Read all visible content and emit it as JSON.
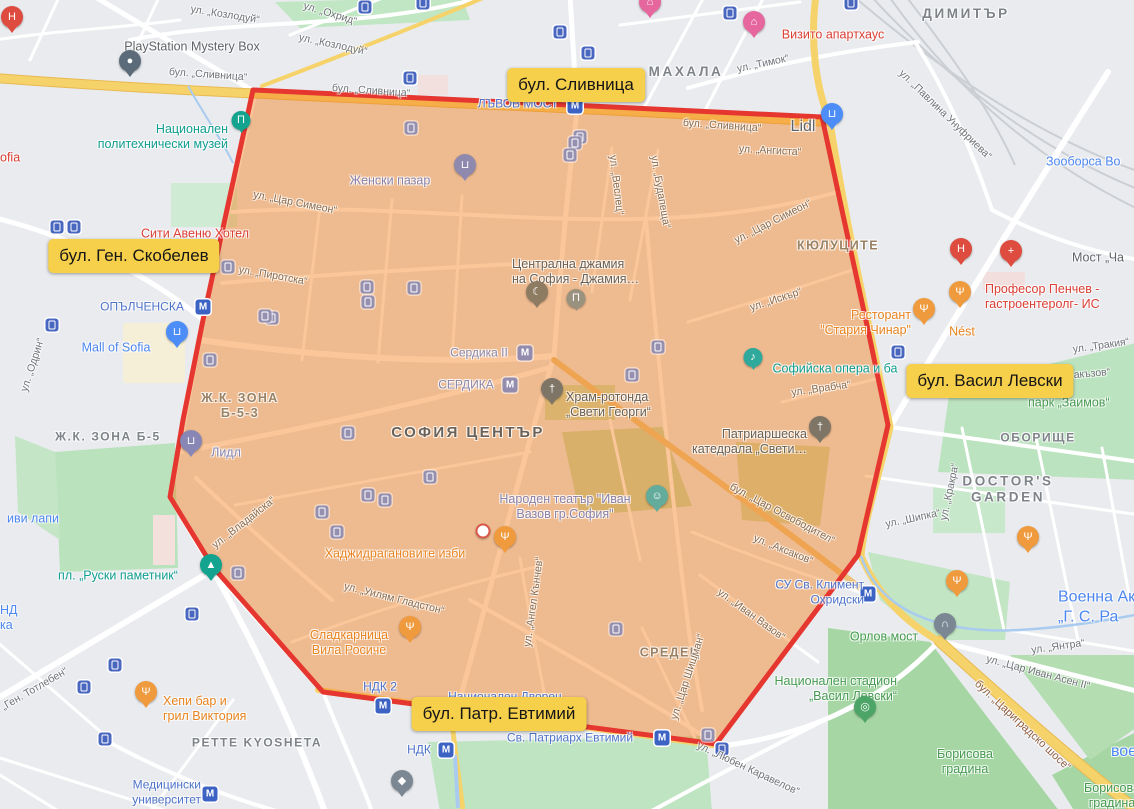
{
  "zone": {
    "points": "253,90 822,117 843,215 868,330 888,425 858,555 716,744 323,692 213,567 170,497 183,420 203,320",
    "fill": "#F5811E",
    "fill_opacity": 0.45,
    "stroke": "#E53730",
    "stroke_width": 5
  },
  "highlight_labels": [
    {
      "t": "бул. Сливница",
      "x": 576,
      "y": 85
    },
    {
      "t": "бул. Ген. Скобелев",
      "x": 134,
      "y": 256
    },
    {
      "t": "бул. Васил Левски",
      "x": 990,
      "y": 381
    },
    {
      "t": "бул. Патр. Евтимий",
      "x": 499,
      "y": 714
    }
  ],
  "map": {
    "districts": [
      {
        "t": "МАХАЛА",
        "x": 686,
        "y": 72,
        "c": "district district-md"
      },
      {
        "t": "ДИМИТЪР",
        "x": 966,
        "y": 14,
        "c": "district district-md"
      },
      {
        "t": "КЮЛУЦИТЕ",
        "x": 838,
        "y": 246,
        "c": "district-in"
      },
      {
        "t": "Ж.К. ЗОНА Б-5",
        "x": 108,
        "y": 437,
        "c": "district"
      },
      {
        "t": "Ж.К. ЗОНА\nБ-5-3",
        "x": 240,
        "y": 406,
        "c": "district-in"
      },
      {
        "t": "СОФИЯ ЦЕНТЪР",
        "x": 468,
        "y": 433,
        "c": "district-lg"
      },
      {
        "t": "СРЕДЕЦ",
        "x": 670,
        "y": 653,
        "c": "district-in"
      },
      {
        "t": "ОБОРИЩЕ",
        "x": 1038,
        "y": 438,
        "c": "district"
      },
      {
        "t": "DOCTOR'S\nGARDEN",
        "x": 1008,
        "y": 490,
        "c": "district district-md"
      },
      {
        "t": "PETTE KYOSHETA",
        "x": 257,
        "y": 743,
        "c": "district"
      }
    ],
    "streets": [
      {
        "t": "ул. „Козлодуй“",
        "x": 225,
        "y": 15,
        "c": "street",
        "r": 9
      },
      {
        "t": "ул. „Козлодуй“",
        "x": 333,
        "y": 45,
        "c": "street",
        "r": 12
      },
      {
        "t": "ул. „Охрид“",
        "x": 330,
        "y": 14,
        "c": "street",
        "r": 17
      },
      {
        "t": "бул. „Сливница“",
        "x": 208,
        "y": 75,
        "c": "street",
        "r": 4
      },
      {
        "t": "бул. „Сливница“",
        "x": 371,
        "y": 91,
        "c": "street",
        "r": 4
      },
      {
        "t": "бул. „Сливница“",
        "x": 722,
        "y": 126,
        "c": "street-in",
        "r": 4
      },
      {
        "t": "ул. „Тимок“",
        "x": 763,
        "y": 64,
        "c": "street",
        "r": -12
      },
      {
        "t": "ул. „Павлина Унуфриева“",
        "x": 945,
        "y": 115,
        "c": "street",
        "r": 44
      },
      {
        "t": "ул. „Ангиста“",
        "x": 770,
        "y": 151,
        "c": "street-in",
        "r": 3
      },
      {
        "t": "ул. „Веслец“",
        "x": 616,
        "y": 185,
        "c": "street-in",
        "r": 83
      },
      {
        "t": "ул. „Будапеща“",
        "x": 660,
        "y": 192,
        "c": "street-in",
        "r": 80
      },
      {
        "t": "ул. „Цар Симеон“",
        "x": 295,
        "y": 203,
        "c": "street-in",
        "r": 11
      },
      {
        "t": "ул. „Цар Симеон“",
        "x": 773,
        "y": 222,
        "c": "street-in",
        "r": -27
      },
      {
        "t": "ул. „Пиротска“",
        "x": 273,
        "y": 276,
        "c": "street-in",
        "r": 10
      },
      {
        "t": "ул. „Искър“",
        "x": 776,
        "y": 300,
        "c": "street-in",
        "r": -18
      },
      {
        "t": "ул. „Тракия“",
        "x": 1101,
        "y": 346,
        "c": "street",
        "r": -8
      },
      {
        "t": "акъзов“",
        "x": 1092,
        "y": 374,
        "c": "street",
        "r": -5
      },
      {
        "t": "ул. „Врабча“",
        "x": 821,
        "y": 389,
        "c": "street-in",
        "r": -8
      },
      {
        "t": "ул. „Одрин“",
        "x": 33,
        "y": 365,
        "c": "street",
        "r": -72
      },
      {
        "t": "ул. „Кракра“",
        "x": 950,
        "y": 492,
        "c": "street",
        "r": -78
      },
      {
        "t": "ул. „Шипка“",
        "x": 913,
        "y": 519,
        "c": "street",
        "r": -12
      },
      {
        "t": "бул. „Цар Освободител“",
        "x": 782,
        "y": 514,
        "c": "street-in",
        "r": 28
      },
      {
        "t": "ул. „Аксаков“",
        "x": 783,
        "y": 550,
        "c": "street-in",
        "r": 22
      },
      {
        "t": "ул. „Владайска“",
        "x": 244,
        "y": 523,
        "c": "street-in",
        "r": -38
      },
      {
        "t": "ул. „Уилям Гладстон“",
        "x": 394,
        "y": 599,
        "c": "street-in",
        "r": 14
      },
      {
        "t": "ул. „Ангел Кънчев“",
        "x": 534,
        "y": 602,
        "c": "street-in",
        "r": -82
      },
      {
        "t": "ул. „Иван Вазов“",
        "x": 751,
        "y": 615,
        "c": "street-in",
        "r": 36
      },
      {
        "t": "ул. „Цар Шишман“",
        "x": 688,
        "y": 677,
        "c": "street-in",
        "r": -72
      },
      {
        "t": "ул. „Любен Каравелов“",
        "x": 748,
        "y": 769,
        "c": "street",
        "r": 25
      },
      {
        "t": "ул. „Янтра“",
        "x": 1058,
        "y": 647,
        "c": "street",
        "r": -8
      },
      {
        "t": "ул. „Цар Иван Асен II“",
        "x": 1038,
        "y": 673,
        "c": "street",
        "r": 15
      },
      {
        "t": "бул. „Цариградско шосе“",
        "x": 1022,
        "y": 726,
        "c": "street-brown",
        "r": 43
      },
      {
        "t": "бул. „Ген. Тотлебен“",
        "x": 25,
        "y": 695,
        "c": "street",
        "r": -30
      }
    ],
    "pois": [
      {
        "t": "PlayStation Mystery Box",
        "x": 192,
        "y": 47,
        "c": "poi-gray poi-lg"
      },
      {
        "t": "Национален\nполитехнически музей",
        "x": 228,
        "y": 137,
        "c": "poi-teal poi-lg",
        "a": "r"
      },
      {
        "t": "Сити Авеню Хотел",
        "x": 195,
        "y": 234,
        "c": "poi-red poi-lg"
      },
      {
        "t": "ofia",
        "x": 0,
        "y": 158,
        "c": "poi-red poi-lg",
        "a": "l"
      },
      {
        "t": "Визито апартхаус",
        "x": 833,
        "y": 35,
        "c": "poi-red poi-lg"
      },
      {
        "t": "Зооборса Во",
        "x": 1046,
        "y": 162,
        "c": "poi-blue poi-lg",
        "a": "l"
      },
      {
        "t": "Мост „Ча",
        "x": 1072,
        "y": 258,
        "c": "poi-gray poi-lg",
        "a": "l"
      },
      {
        "t": "Професор Пенчев -\nгастроентеролг- ИС",
        "x": 985,
        "y": 297,
        "c": "poi-red poi-lg",
        "a": "l"
      },
      {
        "t": "Ресторант\n\"Стария Чинар\"",
        "x": 911,
        "y": 323,
        "c": "poi-orange poi-lg",
        "a": "r"
      },
      {
        "t": "Nést",
        "x": 962,
        "y": 332,
        "c": "poi-orange poi-lg"
      },
      {
        "t": "Софийска опера и ба",
        "x": 835,
        "y": 369,
        "c": "poi-teal poi-lg under"
      },
      {
        "t": "парк „Заимов“",
        "x": 1028,
        "y": 403,
        "c": "poi-green poi-lg",
        "a": "l"
      },
      {
        "t": "Lidl",
        "x": 803,
        "y": 127,
        "c": "poi-gray"
      },
      {
        "t": "Женски пазар",
        "x": 390,
        "y": 181,
        "c": "poi-purple poi-lg"
      },
      {
        "t": "Централна джамия\nна София - Джамия…",
        "x": 512,
        "y": 272,
        "c": "poi-dark poi-lg",
        "a": "l"
      },
      {
        "t": "Храм-ротонда\n„Свети Георги“",
        "x": 566,
        "y": 405,
        "c": "poi-dark poi-lg",
        "a": "l"
      },
      {
        "t": "Патриаршеска\nкатедрала „Свети…",
        "x": 807,
        "y": 442,
        "c": "poi-dark poi-lg",
        "a": "r"
      },
      {
        "t": "Mall of Sofia",
        "x": 116,
        "y": 348,
        "c": "poi-blue poi-lg"
      },
      {
        "t": "Лидл",
        "x": 226,
        "y": 453,
        "c": "poi-muted-blue poi-lg"
      },
      {
        "t": "иви лапи",
        "x": 33,
        "y": 519,
        "c": "poi-blue poi-lg"
      },
      {
        "t": "пл. „Руски паметник“",
        "x": 118,
        "y": 576,
        "c": "poi-teal poi-lg"
      },
      {
        "t": "НД\nка",
        "x": 0,
        "y": 618,
        "c": "poi-blue poi-lg",
        "a": "l"
      },
      {
        "t": "Народен театър \"Иван\nВазов гр.София\"",
        "x": 565,
        "y": 507,
        "c": "poi-purple poi-lg"
      },
      {
        "t": "Хаджидрагановите изби",
        "x": 395,
        "y": 554,
        "c": "poi-orange poi-lg"
      },
      {
        "t": "Хепи бар и\nгрил Виктория",
        "x": 163,
        "y": 709,
        "c": "poi-orange poi-lg",
        "a": "l"
      },
      {
        "t": "Сладкарница\nВила Росиче",
        "x": 349,
        "y": 643,
        "c": "poi-orange poi-lg"
      },
      {
        "t": "Орлов мост",
        "x": 884,
        "y": 637,
        "c": "poi-green poi-lg"
      },
      {
        "t": "Национален стадион\n„Васил Левски“",
        "x": 897,
        "y": 689,
        "c": "poi-green poi-lg",
        "a": "r"
      },
      {
        "t": "Борисова\nградина",
        "x": 965,
        "y": 762,
        "c": "poi-green poi-lg"
      },
      {
        "t": "Борисова\nградина",
        "x": 1112,
        "y": 796,
        "c": "poi-green poi-lg"
      },
      {
        "t": "Военна Ак\n„Г. С. Ра",
        "x": 1058,
        "y": 607,
        "c": "poi-blue",
        "a": "l"
      },
      {
        "t": "вое",
        "x": 1124,
        "y": 752,
        "c": "poi-blue"
      }
    ],
    "metro_stations": [
      {
        "t": "ЛЪВОВ МОСТ",
        "x": 518,
        "y": 104,
        "c": "metro"
      },
      {
        "t": "ОПЪЛЧЕНСКА",
        "x": 142,
        "y": 307,
        "c": "metro"
      },
      {
        "t": "Сердика II",
        "x": 479,
        "y": 353,
        "c": "metro-in"
      },
      {
        "t": "СЕРДИКА",
        "x": 466,
        "y": 385,
        "c": "metro-in"
      },
      {
        "t": "СУ Св. Климент\nОхридски",
        "x": 864,
        "y": 592,
        "c": "metro",
        "a": "r"
      },
      {
        "t": "НДК 2",
        "x": 380,
        "y": 687,
        "c": "metro"
      },
      {
        "t": "Национален Дворец",
        "x": 505,
        "y": 697,
        "c": "metro under"
      },
      {
        "t": "НДК",
        "x": 419,
        "y": 750,
        "c": "metro"
      },
      {
        "t": "Св. Патриарх Евтимий",
        "x": 570,
        "y": 738,
        "c": "metro"
      },
      {
        "t": "Медицински\nуниверситет",
        "x": 201,
        "y": 792,
        "c": "metro",
        "a": "r"
      }
    ],
    "metro_icons": [
      {
        "x": 575,
        "y": 106
      },
      {
        "x": 203,
        "y": 307
      },
      {
        "x": 525,
        "y": 353,
        "m": true
      },
      {
        "x": 510,
        "y": 385,
        "m": true
      },
      {
        "x": 868,
        "y": 594
      },
      {
        "x": 383,
        "y": 706
      },
      {
        "x": 446,
        "y": 750
      },
      {
        "x": 662,
        "y": 738
      },
      {
        "x": 210,
        "y": 794
      }
    ],
    "tram_stops": {
      "blue": [
        [
          423,
          3
        ],
        [
          365,
          7
        ],
        [
          560,
          32
        ],
        [
          588,
          53
        ],
        [
          410,
          78
        ],
        [
          730,
          13
        ],
        [
          851,
          3
        ],
        [
          898,
          352
        ],
        [
          57,
          227
        ],
        [
          74,
          227
        ],
        [
          52,
          325
        ],
        [
          192,
          614
        ],
        [
          115,
          665
        ],
        [
          84,
          687
        ],
        [
          105,
          739
        ],
        [
          722,
          749
        ]
      ],
      "muted": [
        [
          228,
          267
        ],
        [
          272,
          318
        ],
        [
          367,
          287
        ],
        [
          414,
          288
        ],
        [
          368,
          302
        ],
        [
          411,
          128
        ],
        [
          580,
          137
        ],
        [
          575,
          143
        ],
        [
          570,
          155
        ],
        [
          265,
          316
        ],
        [
          210,
          360
        ],
        [
          348,
          433
        ],
        [
          368,
          495
        ],
        [
          385,
          500
        ],
        [
          322,
          512
        ],
        [
          337,
          532
        ],
        [
          238,
          573
        ],
        [
          430,
          477
        ],
        [
          658,
          347
        ],
        [
          632,
          375
        ],
        [
          616,
          629
        ],
        [
          708,
          735
        ]
      ]
    },
    "pins": [
      {
        "k": "hospital",
        "x": 12,
        "y": 28
      },
      {
        "k": "hospital",
        "x": 961,
        "y": 260
      },
      {
        "k": "clinic",
        "x": 1011,
        "y": 262
      },
      {
        "k": "hotel",
        "x": 650,
        "y": 13
      },
      {
        "k": "hotel",
        "x": 754,
        "y": 33
      },
      {
        "k": "playstation",
        "x": 130,
        "y": 72
      },
      {
        "k": "museum",
        "x": 241,
        "y": 130
      },
      {
        "k": "mall",
        "x": 177,
        "y": 343
      },
      {
        "k": "grocery",
        "x": 832,
        "y": 125
      },
      {
        "k": "grocery_muted",
        "x": 191,
        "y": 452
      },
      {
        "k": "market_muted",
        "x": 465,
        "y": 176
      },
      {
        "k": "mosque",
        "x": 537,
        "y": 303
      },
      {
        "k": "museum_muted",
        "x": 576,
        "y": 308
      },
      {
        "k": "church",
        "x": 552,
        "y": 400
      },
      {
        "k": "church",
        "x": 820,
        "y": 438
      },
      {
        "k": "music",
        "x": 753,
        "y": 367
      },
      {
        "k": "monument",
        "x": 211,
        "y": 576
      },
      {
        "k": "theater",
        "x": 657,
        "y": 507
      },
      {
        "k": "restaurant",
        "x": 924,
        "y": 320
      },
      {
        "k": "restaurant",
        "x": 960,
        "y": 303
      },
      {
        "k": "restaurant",
        "x": 505,
        "y": 548
      },
      {
        "k": "restaurant",
        "x": 410,
        "y": 638
      },
      {
        "k": "restaurant",
        "x": 146,
        "y": 703
      },
      {
        "k": "restaurant",
        "x": 1028,
        "y": 548
      },
      {
        "k": "restaurant",
        "x": 957,
        "y": 592
      },
      {
        "k": "stadium",
        "x": 865,
        "y": 718
      },
      {
        "k": "bridge",
        "x": 945,
        "y": 635
      },
      {
        "k": "graduation",
        "x": 402,
        "y": 792
      }
    ],
    "location_dot": {
      "x": 483,
      "y": 531
    }
  },
  "pin_styles": {
    "hospital": {
      "bg": "#DE4B3F",
      "g": "H"
    },
    "clinic": {
      "bg": "#DE4B3F",
      "g": "+"
    },
    "hotel": {
      "bg": "#E5679E",
      "g": "⌂"
    },
    "restaurant": {
      "bg": "#F09A3E",
      "g": "Ψ"
    },
    "playstation": {
      "bg": "#5C6B7A",
      "g": "●"
    },
    "museum": {
      "bg": "#14A38F",
      "g": "Π",
      "round": true
    },
    "museum_muted": {
      "bg": "#9A917F",
      "g": "Π",
      "round": true
    },
    "music": {
      "bg": "#2FA99B",
      "g": "♪",
      "round": true
    },
    "mall": {
      "bg": "#4D8DF7",
      "g": "⊔"
    },
    "grocery": {
      "bg": "#4D8DF7",
      "g": "⊔"
    },
    "grocery_muted": {
      "bg": "#8886B4",
      "g": "⊔"
    },
    "market_muted": {
      "bg": "#8F89AE",
      "g": "⊔"
    },
    "mosque": {
      "bg": "#8D7B62",
      "g": "☾"
    },
    "church": {
      "bg": "#7E7567",
      "g": "†"
    },
    "monument": {
      "bg": "#14A38F",
      "g": "▲"
    },
    "theater": {
      "bg": "#63AC9C",
      "g": "☺"
    },
    "stadium": {
      "bg": "#4CA466",
      "g": "◎"
    },
    "bridge": {
      "bg": "#7C8794",
      "g": "∩"
    },
    "graduation": {
      "bg": "#7C8794",
      "g": "◆"
    }
  }
}
